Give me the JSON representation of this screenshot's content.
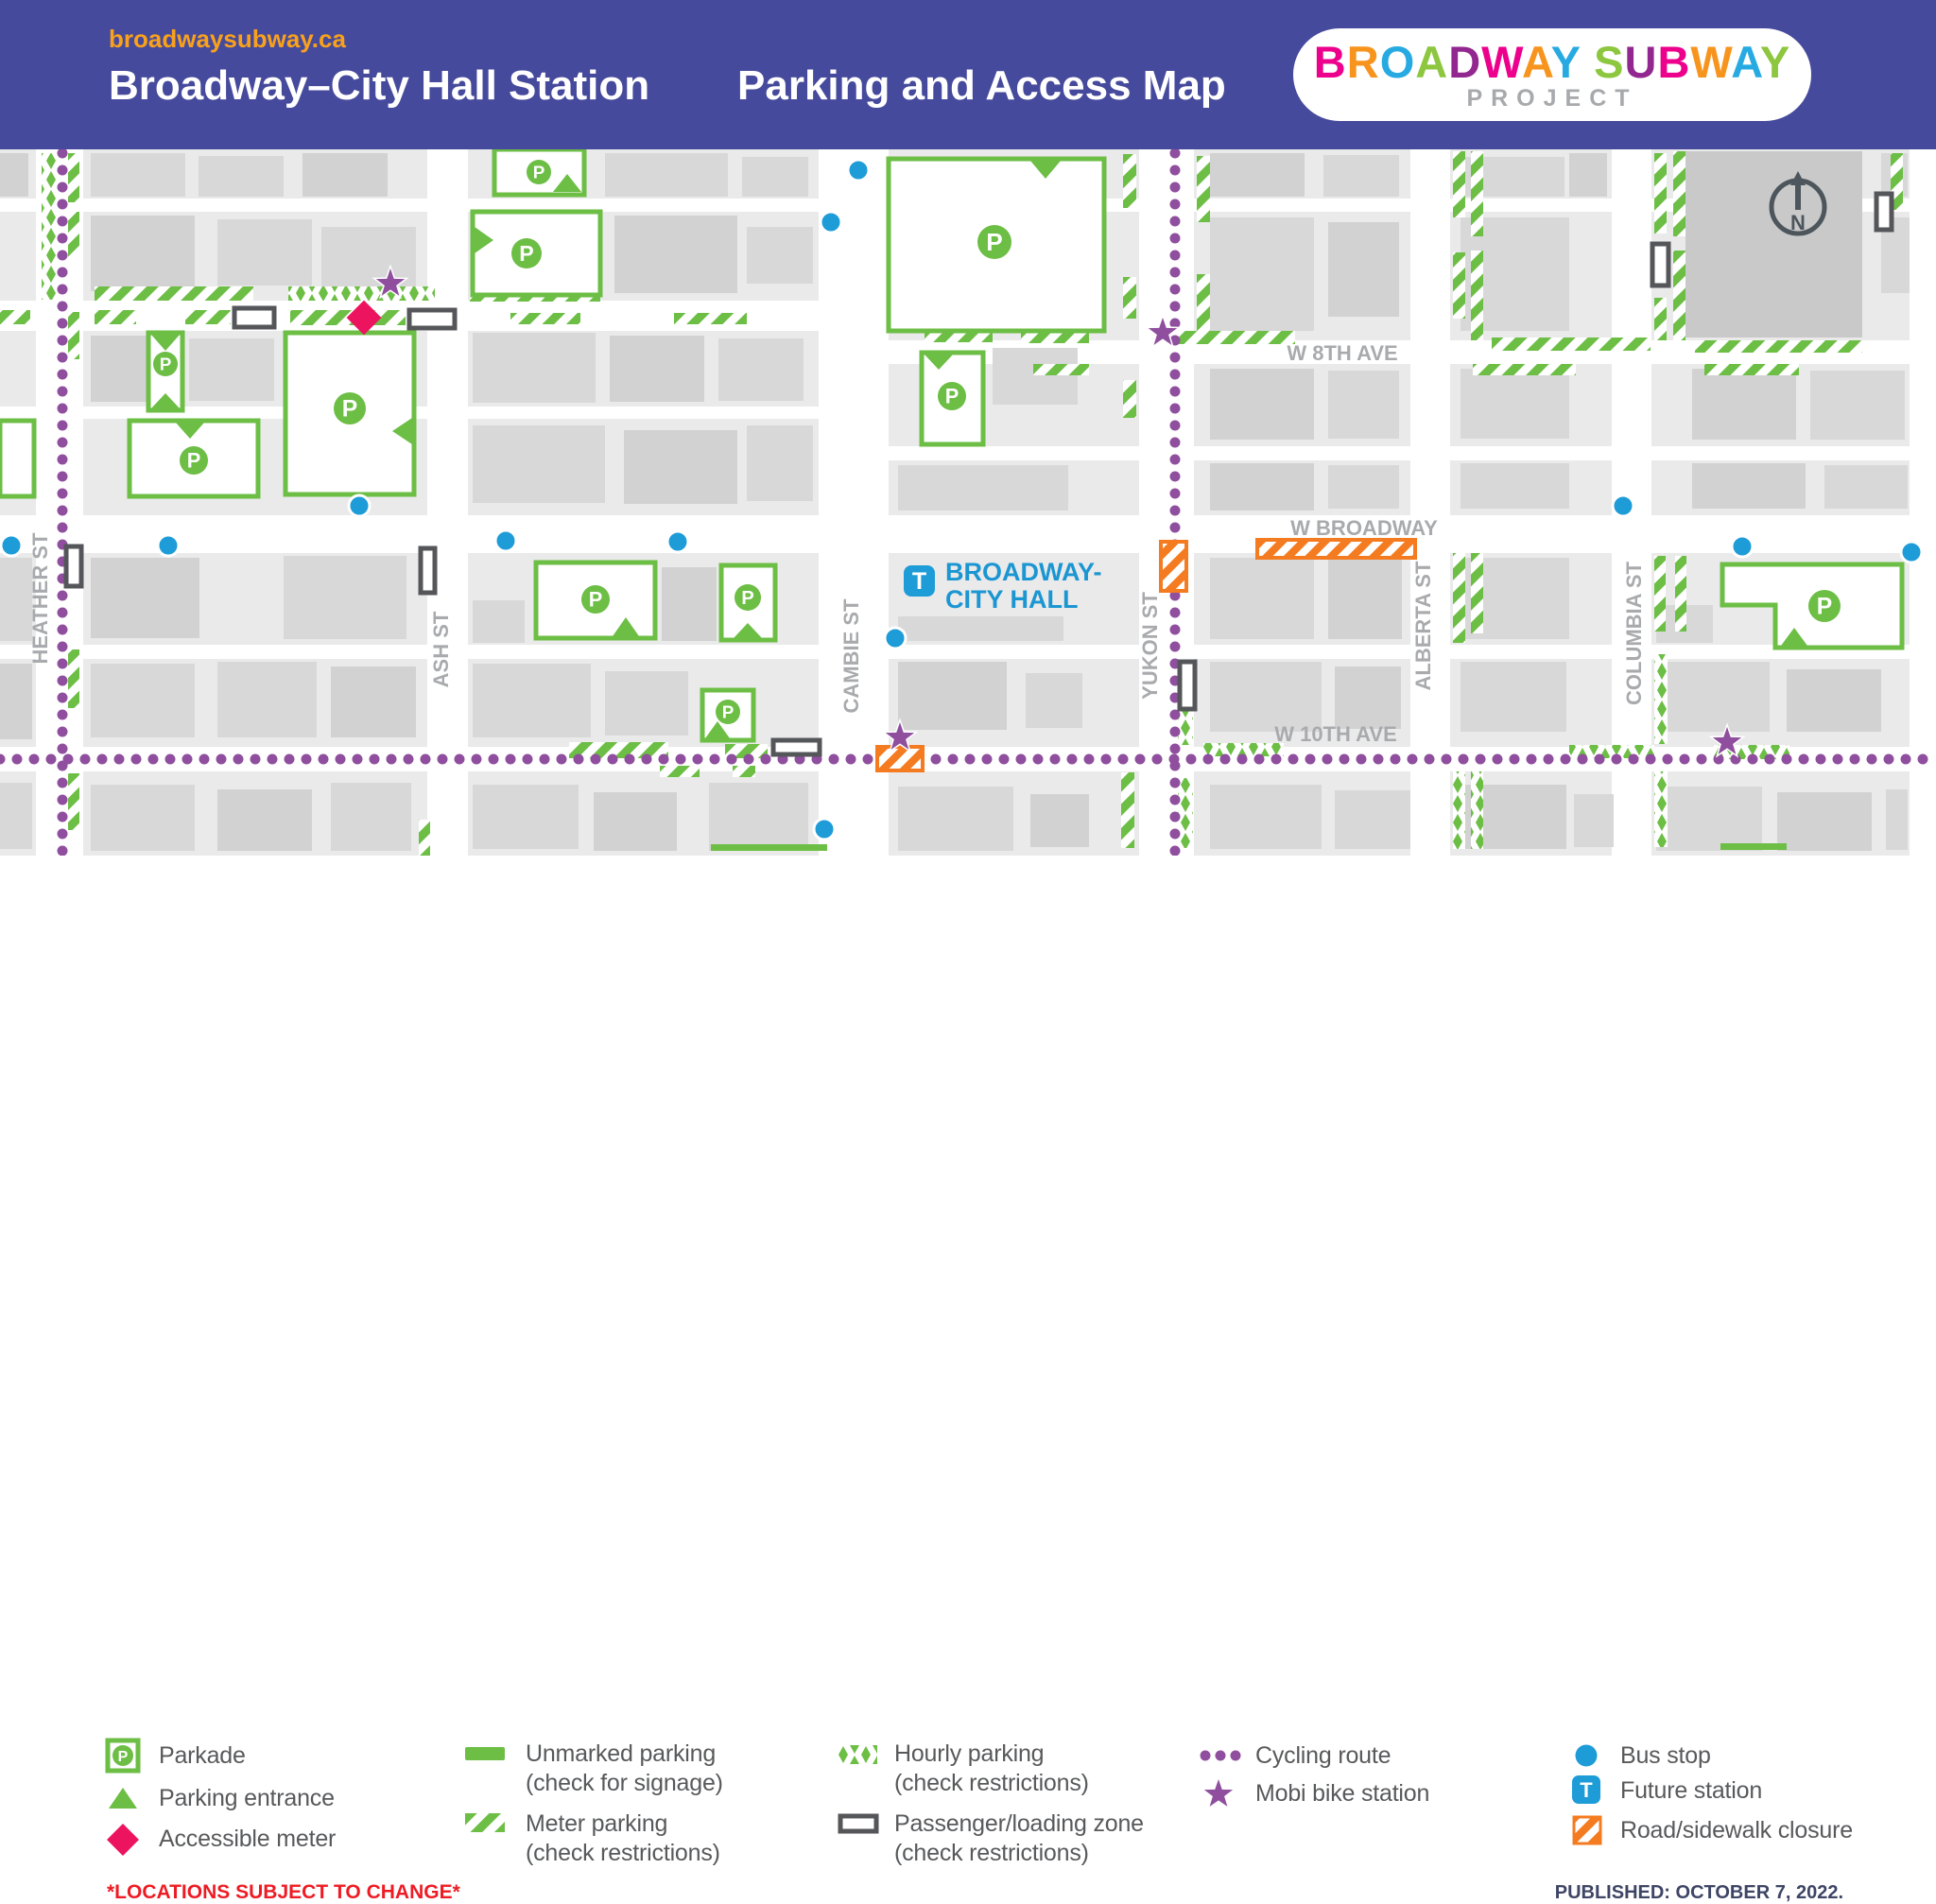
{
  "colors": {
    "header_bg": "#464A9C",
    "accent_orange": "#F9A11B",
    "parking_green": "#6CBE45",
    "cycling_purple": "#8F4F9E",
    "bus_blue": "#1E9CD8",
    "station_blue": "#1B96D2",
    "accessible_pink": "#EC135F",
    "closure_orange": "#F47B20",
    "street_label_gray": "#A8AAAD",
    "legend_text": "#58595B",
    "note_red": "#ED1C24",
    "published_navy": "#3E4565",
    "logo_gray": "#A7A9AC",
    "logo_palette": [
      "#EC008C",
      "#F7941D",
      "#27AAE1",
      "#8DC63F",
      "#92278F"
    ]
  },
  "header": {
    "website": "broadwaysubway.ca",
    "station_title": "Broadway–City Hall Station",
    "map_title": "Parking and Access Map",
    "logo_title": "BROADWAY SUBWAY",
    "logo_subtitle": "PROJECT"
  },
  "map": {
    "north_label": "N",
    "parkade_letter": "P",
    "station": {
      "symbol": "T",
      "line1": "BROADWAY-",
      "line2": "CITY HALL"
    },
    "streets": {
      "heather": "HEATHER ST",
      "ash": "ASH ST",
      "cambie": "CAMBIE ST",
      "yukon": "YUKON ST",
      "alberta": "ALBERTA ST",
      "columbia": "COLUMBIA ST",
      "w8th": "W 8TH AVE",
      "wbroadway": "W BROADWAY",
      "w10th": "W 10TH AVE"
    }
  },
  "legend": {
    "col1": [
      {
        "icon": "parkade-icon",
        "label": "Parkade"
      },
      {
        "icon": "parking-entrance-icon",
        "label": "Parking entrance"
      },
      {
        "icon": "accessible-meter-icon",
        "label": "Accessible meter"
      }
    ],
    "col2": [
      {
        "icon": "unmarked-parking-icon",
        "label": "Unmarked parking",
        "sub": "(check for signage)"
      },
      {
        "icon": "meter-parking-icon",
        "label": "Meter parking",
        "sub": "(check restrictions)"
      }
    ],
    "col3": [
      {
        "icon": "hourly-parking-icon",
        "label": "Hourly parking",
        "sub": "(check restrictions)"
      },
      {
        "icon": "loading-zone-icon",
        "label": "Passenger/loading zone",
        "sub": "(check restrictions)"
      }
    ],
    "col4": [
      {
        "icon": "cycling-route-icon",
        "label": "Cycling route"
      },
      {
        "icon": "mobi-station-icon",
        "label": "Mobi bike station"
      }
    ],
    "col5": [
      {
        "icon": "bus-stop-icon",
        "label": "Bus stop"
      },
      {
        "icon": "future-station-icon",
        "label": "Future station"
      },
      {
        "icon": "road-closure-icon",
        "label": "Road/sidewalk closure"
      }
    ],
    "note": "*LOCATIONS SUBJECT TO CHANGE*",
    "published": "PUBLISHED: OCTOBER 7, 2022."
  }
}
